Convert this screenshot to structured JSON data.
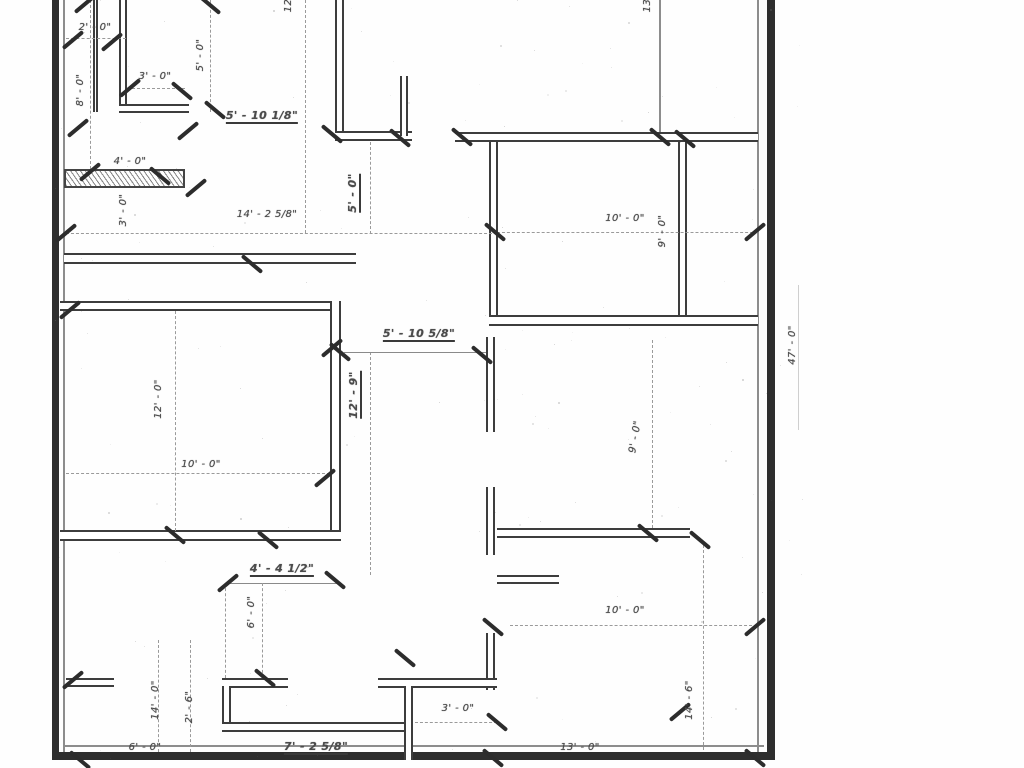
{
  "drawing": {
    "type": "architectural-floor-plan",
    "colors": {
      "wall": "#2e2e2e",
      "wall_edge": "#3d3d3d",
      "label": "#4b4b4b",
      "dash": "#9a9a9a",
      "background": "#fefefe"
    },
    "labels": [
      {
        "text": "12'",
        "x": 289,
        "y": 4,
        "rot": -90,
        "ul": false
      },
      {
        "text": "13'",
        "x": 648,
        "y": 4,
        "rot": -90,
        "ul": false
      },
      {
        "text": "2' - 0\"",
        "x": 95,
        "y": 28,
        "rot": 0,
        "ul": false
      },
      {
        "text": "8' - 0\"",
        "x": 81,
        "y": 90,
        "rot": -90,
        "ul": false
      },
      {
        "text": "3' - 0\"",
        "x": 155,
        "y": 77,
        "rot": 0,
        "ul": false
      },
      {
        "text": "5' - 0\"",
        "x": 201,
        "y": 55,
        "rot": -90,
        "ul": false
      },
      {
        "text": "5' - 10 1/8\"",
        "x": 262,
        "y": 117,
        "rot": 0,
        "ul": true
      },
      {
        "text": "4' - 0\"",
        "x": 130,
        "y": 162,
        "rot": 0,
        "ul": false
      },
      {
        "text": "3' - 0\"",
        "x": 124,
        "y": 210,
        "rot": -90,
        "ul": false
      },
      {
        "text": "14' - 2 5/8\"",
        "x": 267,
        "y": 215,
        "rot": 0,
        "ul": false
      },
      {
        "text": "5' - 0\"",
        "x": 354,
        "y": 193,
        "rot": -90,
        "ul": true
      },
      {
        "text": "10' - 0\"",
        "x": 625,
        "y": 219,
        "rot": 0,
        "ul": false
      },
      {
        "text": "9' - 0\"",
        "x": 663,
        "y": 231,
        "rot": -90,
        "ul": false
      },
      {
        "text": "12' - 0\"",
        "x": 159,
        "y": 399,
        "rot": -90,
        "ul": false
      },
      {
        "text": "10' - 0\"",
        "x": 201,
        "y": 465,
        "rot": 0,
        "ul": false
      },
      {
        "text": "5' - 10 5/8\"",
        "x": 419,
        "y": 335,
        "rot": 0,
        "ul": true
      },
      {
        "text": "12' - 9\"",
        "x": 355,
        "y": 395,
        "rot": -90,
        "ul": true
      },
      {
        "text": "9' - 0\"",
        "x": 636,
        "y": 437,
        "rot": -80,
        "ul": false
      },
      {
        "text": "4' - 4 1/2\"",
        "x": 282,
        "y": 570,
        "rot": 0,
        "ul": true
      },
      {
        "text": "6' - 0\"",
        "x": 252,
        "y": 612,
        "rot": -90,
        "ul": false
      },
      {
        "text": "10' - 0\"",
        "x": 625,
        "y": 611,
        "rot": 0,
        "ul": false
      },
      {
        "text": "14' - 0\"",
        "x": 156,
        "y": 700,
        "rot": -90,
        "ul": false
      },
      {
        "text": "2' - 6\"",
        "x": 190,
        "y": 707,
        "rot": -90,
        "ul": false
      },
      {
        "text": "6' - 0\"",
        "x": 145,
        "y": 748,
        "rot": 0,
        "ul": false
      },
      {
        "text": "7' - 2 5/8\"",
        "x": 316,
        "y": 748,
        "rot": 0,
        "ul": true
      },
      {
        "text": "3' - 0\"",
        "x": 458,
        "y": 709,
        "rot": 0,
        "ul": false
      },
      {
        "text": "13' - 0\"",
        "x": 580,
        "y": 748,
        "rot": 0,
        "ul": false
      },
      {
        "text": "14' - 6\"",
        "x": 690,
        "y": 700,
        "rot": -90,
        "ul": false
      },
      {
        "text": "47' - 0\"",
        "x": 793,
        "y": 345,
        "rot": -90,
        "ul": false
      }
    ],
    "walls": [
      {
        "x": 52,
        "y": 0,
        "w": 7,
        "h": 760,
        "s": "solid"
      },
      {
        "x": 63,
        "y": 0,
        "w": 2,
        "h": 760,
        "s": "thin"
      },
      {
        "x": 767,
        "y": 0,
        "w": 8,
        "h": 760,
        "s": "solid"
      },
      {
        "x": 757,
        "y": 0,
        "w": 2,
        "h": 760,
        "s": "thin"
      },
      {
        "x": 52,
        "y": 752,
        "w": 723,
        "h": 8,
        "s": "solid"
      },
      {
        "x": 64,
        "y": 745,
        "w": 700,
        "h": 2,
        "s": "thin"
      },
      {
        "x": 659,
        "y": 0,
        "w": 2,
        "h": 132,
        "s": "thin"
      },
      {
        "x": 93,
        "y": 0,
        "w": 5,
        "h": 112,
        "s": "double"
      },
      {
        "x": 119,
        "y": 0,
        "w": 8,
        "h": 112,
        "s": "double"
      },
      {
        "x": 119,
        "y": 104,
        "w": 70,
        "h": 9,
        "s": "double"
      },
      {
        "x": 335,
        "y": 0,
        "w": 9,
        "h": 141,
        "s": "double"
      },
      {
        "x": 335,
        "y": 131,
        "w": 77,
        "h": 10,
        "s": "double"
      },
      {
        "x": 400,
        "y": 76,
        "w": 8,
        "h": 60,
        "s": "double"
      },
      {
        "x": 455,
        "y": 132,
        "w": 303,
        "h": 10,
        "s": "double"
      },
      {
        "x": 489,
        "y": 142,
        "w": 9,
        "h": 181,
        "s": "double"
      },
      {
        "x": 678,
        "y": 142,
        "w": 9,
        "h": 181,
        "s": "double"
      },
      {
        "x": 489,
        "y": 315,
        "w": 269,
        "h": 11,
        "s": "double"
      },
      {
        "x": 64,
        "y": 253,
        "w": 292,
        "h": 11,
        "s": "double"
      },
      {
        "x": 60,
        "y": 301,
        "w": 281,
        "h": 10,
        "s": "double"
      },
      {
        "x": 330,
        "y": 301,
        "w": 11,
        "h": 240,
        "s": "double"
      },
      {
        "x": 60,
        "y": 530,
        "w": 281,
        "h": 11,
        "s": "double"
      },
      {
        "x": 486,
        "y": 337,
        "w": 9,
        "h": 95,
        "s": "double"
      },
      {
        "x": 486,
        "y": 487,
        "w": 9,
        "h": 68,
        "s": "double"
      },
      {
        "x": 497,
        "y": 528,
        "w": 193,
        "h": 10,
        "s": "double"
      },
      {
        "x": 497,
        "y": 575,
        "w": 62,
        "h": 9,
        "s": "double"
      },
      {
        "x": 486,
        "y": 633,
        "w": 9,
        "h": 57,
        "s": "double"
      },
      {
        "x": 378,
        "y": 678,
        "w": 119,
        "h": 10,
        "s": "double"
      },
      {
        "x": 222,
        "y": 678,
        "w": 66,
        "h": 10,
        "s": "double"
      },
      {
        "x": 222,
        "y": 686,
        "w": 9,
        "h": 44,
        "s": "double"
      },
      {
        "x": 222,
        "y": 722,
        "w": 191,
        "h": 10,
        "s": "double"
      },
      {
        "x": 404,
        "y": 686,
        "w": 9,
        "h": 74,
        "s": "double"
      },
      {
        "x": 66,
        "y": 678,
        "w": 48,
        "h": 9,
        "s": "double"
      },
      {
        "x": 64,
        "y": 169,
        "w": 121,
        "h": 19,
        "s": "hatch"
      }
    ],
    "dashes": [
      {
        "x": 90,
        "y": 0,
        "len": 169,
        "o": "v"
      },
      {
        "x": 66,
        "y": 38,
        "len": 60,
        "o": "h"
      },
      {
        "x": 127,
        "y": 88,
        "len": 58,
        "o": "h"
      },
      {
        "x": 210,
        "y": 0,
        "len": 112,
        "o": "v"
      },
      {
        "x": 305,
        "y": 0,
        "len": 233,
        "o": "v"
      },
      {
        "x": 66,
        "y": 233,
        "len": 431,
        "o": "h"
      },
      {
        "x": 497,
        "y": 232,
        "len": 261,
        "o": "h"
      },
      {
        "x": 370,
        "y": 142,
        "len": 92,
        "o": "v"
      },
      {
        "x": 175,
        "y": 311,
        "len": 220,
        "o": "v"
      },
      {
        "x": 66,
        "y": 473,
        "len": 264,
        "o": "h"
      },
      {
        "x": 370,
        "y": 352,
        "len": 223,
        "o": "v"
      },
      {
        "x": 652,
        "y": 340,
        "len": 188,
        "o": "v"
      },
      {
        "x": 228,
        "y": 583,
        "len": 110,
        "o": "h",
        "solid": true
      },
      {
        "x": 344,
        "y": 352,
        "len": 142,
        "o": "h",
        "solid": true
      },
      {
        "x": 225,
        "y": 583,
        "len": 95,
        "o": "v"
      },
      {
        "x": 262,
        "y": 583,
        "len": 95,
        "o": "v"
      },
      {
        "x": 510,
        "y": 625,
        "len": 247,
        "o": "h"
      },
      {
        "x": 158,
        "y": 640,
        "len": 112,
        "o": "v"
      },
      {
        "x": 190,
        "y": 640,
        "len": 112,
        "o": "v"
      },
      {
        "x": 415,
        "y": 722,
        "len": 82,
        "o": "h"
      },
      {
        "x": 703,
        "y": 545,
        "len": 205,
        "o": "v"
      },
      {
        "x": 798,
        "y": 285,
        "len": 145,
        "o": "v",
        "solid": true,
        "light": true
      }
    ],
    "ticks": [
      {
        "x": 85,
        "y": 4,
        "a": -40
      },
      {
        "x": 210,
        "y": 5,
        "a": 40
      },
      {
        "x": 73,
        "y": 40,
        "a": -40
      },
      {
        "x": 112,
        "y": 42,
        "a": -40
      },
      {
        "x": 130,
        "y": 88,
        "a": -40
      },
      {
        "x": 182,
        "y": 91,
        "a": 40
      },
      {
        "x": 78,
        "y": 128,
        "a": -40
      },
      {
        "x": 188,
        "y": 131,
        "a": -40
      },
      {
        "x": 215,
        "y": 110,
        "a": 40
      },
      {
        "x": 332,
        "y": 134,
        "a": 40
      },
      {
        "x": 400,
        "y": 138,
        "a": 40
      },
      {
        "x": 462,
        "y": 137,
        "a": 40
      },
      {
        "x": 90,
        "y": 172,
        "a": -40
      },
      {
        "x": 160,
        "y": 176,
        "a": 40
      },
      {
        "x": 196,
        "y": 188,
        "a": -40
      },
      {
        "x": 252,
        "y": 264,
        "a": 40
      },
      {
        "x": 66,
        "y": 233,
        "a": -40
      },
      {
        "x": 495,
        "y": 232,
        "a": 40
      },
      {
        "x": 660,
        "y": 137,
        "a": 40
      },
      {
        "x": 685,
        "y": 139,
        "a": 40
      },
      {
        "x": 755,
        "y": 232,
        "a": -40
      },
      {
        "x": 70,
        "y": 310,
        "a": -40
      },
      {
        "x": 340,
        "y": 352,
        "a": 40
      },
      {
        "x": 482,
        "y": 355,
        "a": 40
      },
      {
        "x": 332,
        "y": 348,
        "a": -40
      },
      {
        "x": 325,
        "y": 478,
        "a": -40
      },
      {
        "x": 175,
        "y": 535,
        "a": 40
      },
      {
        "x": 268,
        "y": 540,
        "a": 40
      },
      {
        "x": 648,
        "y": 533,
        "a": 40
      },
      {
        "x": 700,
        "y": 540,
        "a": 40
      },
      {
        "x": 228,
        "y": 583,
        "a": -40
      },
      {
        "x": 335,
        "y": 580,
        "a": 40
      },
      {
        "x": 265,
        "y": 678,
        "a": 40
      },
      {
        "x": 405,
        "y": 658,
        "a": 40
      },
      {
        "x": 493,
        "y": 627,
        "a": 40
      },
      {
        "x": 755,
        "y": 627,
        "a": -40
      },
      {
        "x": 73,
        "y": 680,
        "a": -40
      },
      {
        "x": 80,
        "y": 760,
        "a": 40
      },
      {
        "x": 497,
        "y": 722,
        "a": 40
      },
      {
        "x": 680,
        "y": 712,
        "a": -40
      },
      {
        "x": 755,
        "y": 758,
        "a": 40
      },
      {
        "x": 493,
        "y": 758,
        "a": 40
      }
    ]
  }
}
